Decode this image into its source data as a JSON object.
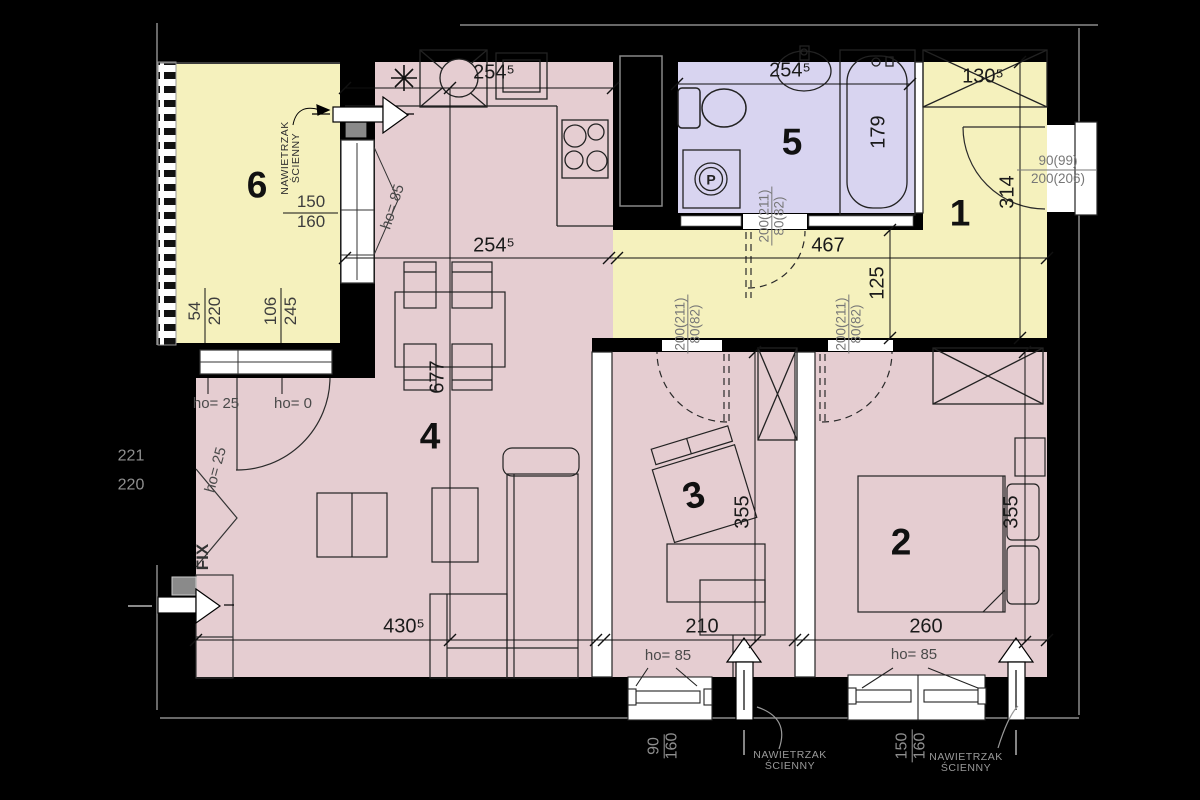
{
  "rooms": {
    "balcony": {
      "number": "6"
    },
    "living": {
      "number": "4"
    },
    "bathroom": {
      "number": "5"
    },
    "hall": {
      "number": "1"
    },
    "study": {
      "number": "3"
    },
    "bedroom": {
      "number": "2"
    }
  },
  "colors": {
    "room_pink": "#e5cdd1",
    "room_yellow": "#f5f1bd",
    "room_purple": "#d8d4f0",
    "wall_black": "#000000"
  },
  "dims": {
    "kitchen_top": "254⁵",
    "kitchen_mid": "254⁵",
    "bathroom_width": "254⁵",
    "closet_width": "130⁵",
    "tub": "179",
    "hall_length": "467",
    "hall_width": "125",
    "entry_depth": "314",
    "living_length": "677",
    "study_depth": "355",
    "bedroom_depth": "355",
    "living_width": "430⁵",
    "study_width": "210",
    "bedroom_width": "260",
    "balcony_a1": "54",
    "balcony_a2": "220",
    "balcony_b1": "106",
    "balcony_b2": "245",
    "balcony_win_a": "150",
    "balcony_win_b": "160",
    "level_1": "221",
    "level_2": "220",
    "win3_a": "90",
    "win3_b": "160",
    "win2_a": "150",
    "win2_b": "160"
  },
  "doors": {
    "entry_a": "90(99)",
    "entry_b": "200(206)",
    "interior_a": "200(211)",
    "interior_b": "80(82)"
  },
  "labels": {
    "vent_1": "NAWIETRZAK",
    "vent_2": "ŚCIENNY",
    "fix": "FIX",
    "ho_25": "ho= 25",
    "ho_0": "ho= 0",
    "ho_85": "ho= 85",
    "washer": "P"
  }
}
